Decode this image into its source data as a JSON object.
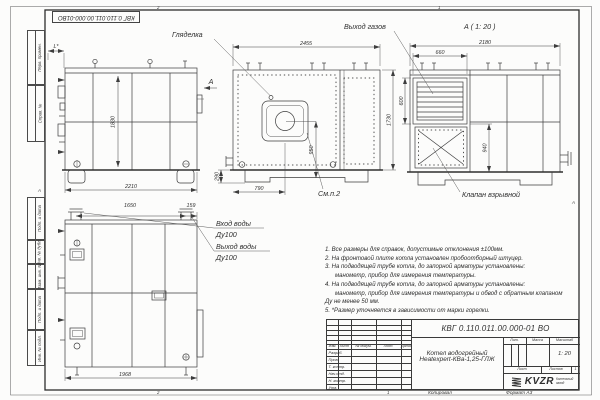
{
  "stamp_box": {
    "number": "КВГ 0.110.011.00.000-01ВО"
  },
  "margin": {
    "labels": {
      "l1": "Перв. примен.",
      "l2": "Справ. №",
      "l3": "Подп. и дата",
      "l4": "Инв. № дубл.",
      "l5": "Взам. инв. №",
      "l6": "Подп. и дата",
      "l7": "Инв. № подл."
    },
    "zone_a_left": "А",
    "zone_a_right": "А",
    "zone_top_2": "2",
    "zone_top_1": "1",
    "zone_bottom_2": "2",
    "zone_bottom_1": "1"
  },
  "views": {
    "left": {
      "dim_l": "L*",
      "dim_height": "1830",
      "dim_width": "2210",
      "arrow_label": "А"
    },
    "front": {
      "callout_sight": "Гляделка",
      "callout_see": "См.п.2",
      "dim_width": "2455",
      "dim_height": "1730",
      "dim_burner_axis": "950",
      "dim_burner_x": "790",
      "dim_base": "290"
    },
    "side": {
      "title": "А ( 1: 20 )",
      "callout_gas": "Выход газов",
      "callout_valve": "Клапан взрывной",
      "dim_width": "2180",
      "dim_louver_w": "660",
      "dim_louver_h": "600",
      "dim_mid": "940"
    },
    "back": {
      "callout_in_1": "Вход воды",
      "callout_in_2": "Ду100",
      "callout_out_1": "Выход воды",
      "callout_out_2": "Ду100",
      "dim_pipe_span": "1650",
      "dim_pipe_edge": "159",
      "dim_width": "1968"
    }
  },
  "notes": {
    "line1": "1. Все размеры для справок, допустимые отклонения ±100мм.",
    "line2": "2. На фронтовой плите котла установлен пробоотборный штуцер.",
    "line3": "3. На подводящей трубе котла, до запорной арматуры установлены:",
    "line4": "манометр, прибор для измерения температуры.",
    "line5": "4. На подводящей трубе котла, до запорной арматуры установлены:",
    "line6": "манометр, прибор для измерения температуры и обвод с обратным клапаном",
    "line7": "Ду не менее 50 мм.",
    "line8": "5. *Размер уточняется в зависимости от марки горелки."
  },
  "titleblock": {
    "doc_number": "КВГ 0.110.011.00.000-01 ВО",
    "product_line1": "Котел водогрейный",
    "product_line2": "Heatexpert-КВа-1,25-ГЛЖ",
    "col_izm": "Изм.",
    "col_list": "Лист",
    "col_doc": "№ докум.",
    "col_podp": "Подп.",
    "col_data": "Дата",
    "rows": {
      "r1": "Разраб.",
      "r2": "Пров.",
      "r3": "Т. контр.",
      "r4": "Нач.отд.",
      "r5": "Н. контр.",
      "r6": "Утв."
    },
    "lit_label": "Лит.",
    "mass_label": "Масса",
    "scale_label": "Масштаб",
    "scale_value": "1: 20",
    "sheet_label": "Лист",
    "sheets_label": "Листов",
    "sheets_value": "1",
    "logo_text": "KVZR",
    "logo_caption1": "Котельный",
    "logo_caption2": "завод",
    "copied": "Копировал",
    "format": "Формат А3"
  }
}
